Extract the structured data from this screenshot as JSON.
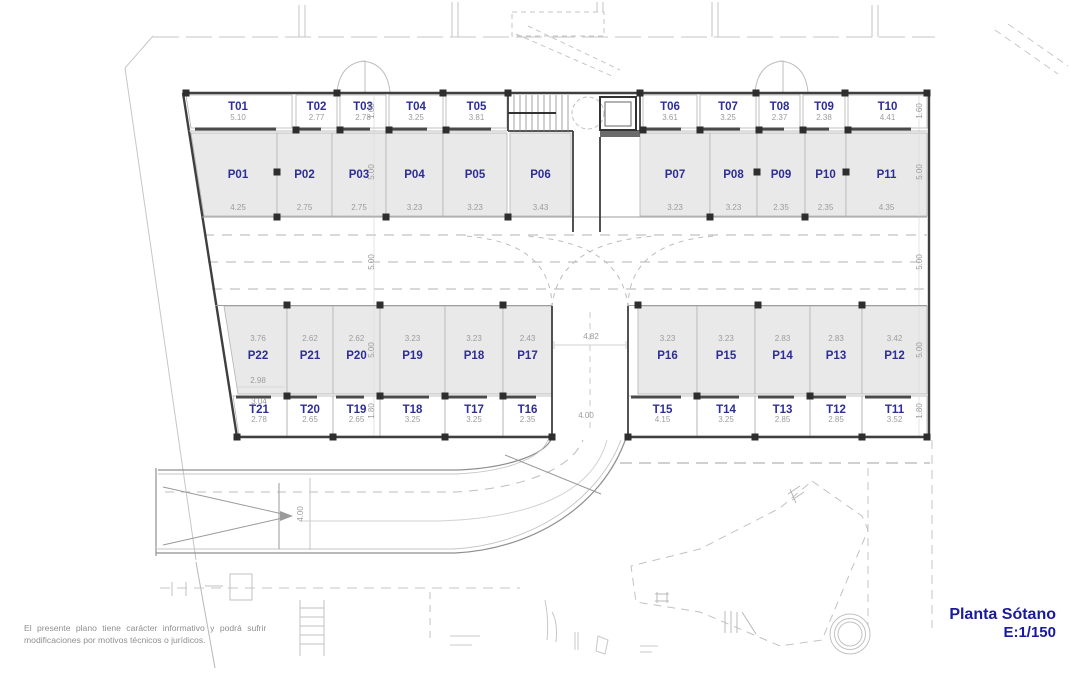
{
  "plan": {
    "title": "Planta Sótano",
    "scale": "E:1/150",
    "disclaimer_line1": "El presente plano tiene carácter informativo y podrá sufrir",
    "disclaimer_line2": "modificaciones por motivos técnicos o jurídicos."
  },
  "units": {
    "storage_top": [
      {
        "id": "T01",
        "dim": "5.10"
      },
      {
        "id": "T02",
        "dim": "2.77"
      },
      {
        "id": "T03",
        "dim": "2.78"
      },
      {
        "id": "T04",
        "dim": "3.25"
      },
      {
        "id": "T05",
        "dim": "3.81"
      },
      {
        "id": "T06",
        "dim": "3.61"
      },
      {
        "id": "T07",
        "dim": "3.25"
      },
      {
        "id": "T08",
        "dim": "2.37"
      },
      {
        "id": "T09",
        "dim": "2.38"
      },
      {
        "id": "T10",
        "dim": "4.41"
      }
    ],
    "parking_top": [
      {
        "id": "P01",
        "dim": "4.25"
      },
      {
        "id": "P02",
        "dim": "2.75"
      },
      {
        "id": "P03",
        "dim": "2.75"
      },
      {
        "id": "P04",
        "dim": "3.23"
      },
      {
        "id": "P05",
        "dim": "3.23"
      },
      {
        "id": "P06",
        "dim": "3.43"
      },
      {
        "id": "P07",
        "dim": "3.23"
      },
      {
        "id": "P08",
        "dim": "3.23"
      },
      {
        "id": "P09",
        "dim": "2.35"
      },
      {
        "id": "P10",
        "dim": "2.35"
      },
      {
        "id": "P11",
        "dim": "4.35"
      }
    ],
    "parking_bottom": [
      {
        "id": "P22",
        "dim": "3.76",
        "dim2": "2.98"
      },
      {
        "id": "P21",
        "dim": "2.62"
      },
      {
        "id": "P20",
        "dim": "2.62"
      },
      {
        "id": "P19",
        "dim": "3.23"
      },
      {
        "id": "P18",
        "dim": "3.23"
      },
      {
        "id": "P17",
        "dim": "2.43"
      },
      {
        "id": "P16",
        "dim": "3.23"
      },
      {
        "id": "P15",
        "dim": "3.23"
      },
      {
        "id": "P14",
        "dim": "2.83"
      },
      {
        "id": "P13",
        "dim": "2.83"
      },
      {
        "id": "P12",
        "dim": "3.42"
      }
    ],
    "storage_bottom": [
      {
        "id": "T21",
        "dim": "2.78",
        "dim_above": "3.04"
      },
      {
        "id": "T20",
        "dim": "2.65"
      },
      {
        "id": "T19",
        "dim": "2.65"
      },
      {
        "id": "T18",
        "dim": "3.25"
      },
      {
        "id": "T17",
        "dim": "3.25"
      },
      {
        "id": "T16",
        "dim": "2.35"
      },
      {
        "id": "T15",
        "dim": "4.15"
      },
      {
        "id": "T14",
        "dim": "3.25"
      },
      {
        "id": "T13",
        "dim": "2.85"
      },
      {
        "id": "T12",
        "dim": "2.85"
      },
      {
        "id": "T11",
        "dim": "3.52"
      }
    ]
  },
  "dimensions": {
    "vertical_left": [
      "1.60",
      "5.00",
      "5.00",
      "5.00",
      "1.80"
    ],
    "vertical_right": [
      "1.60",
      "5.00",
      "5.00",
      "5.00",
      "1.80"
    ],
    "ramp_top_width": "4.82",
    "ramp_entry_width": "4.00",
    "access_ramp_width": "4.00"
  },
  "colors": {
    "unit_label": "#2d2d96",
    "dimension_text": "#9c9c9c",
    "wall": "#3f3f3f",
    "parking_fill": "#e9e9e9",
    "site_line": "#c6c6c6",
    "title_text": "#1a1a9e"
  }
}
